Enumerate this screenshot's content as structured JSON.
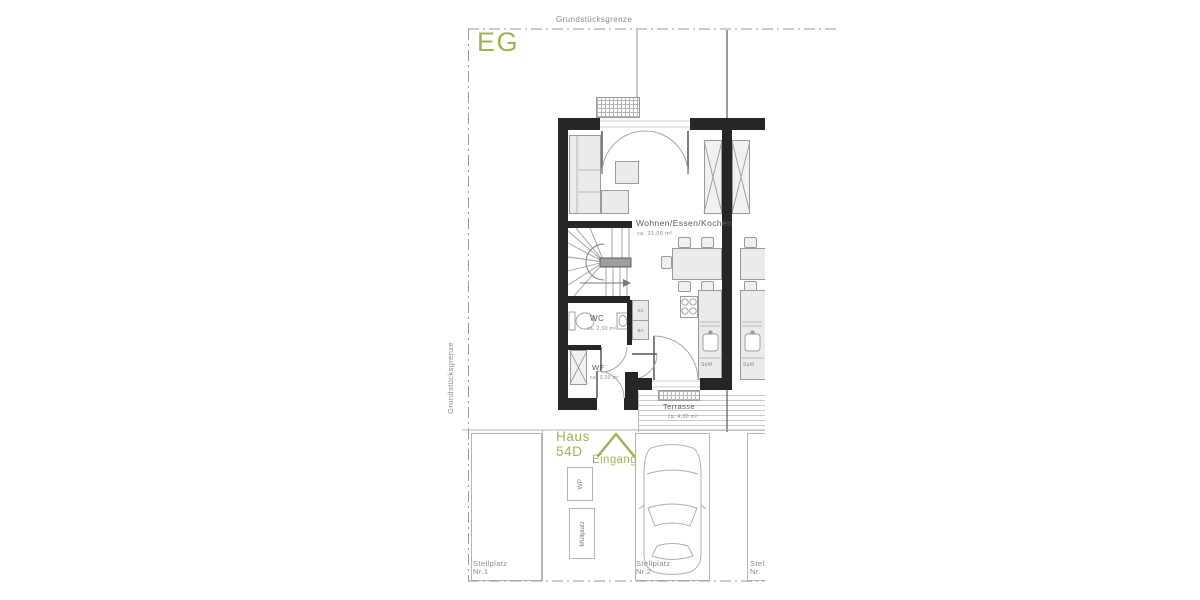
{
  "colors": {
    "accent_green": "#a3b155",
    "wall_black": "#262626",
    "line_gray": "#9a9a9a",
    "text_gray": "#8a8a8a"
  },
  "plan": {
    "floor_label": "EG",
    "boundary": {
      "top_label": "Grundstücksgrenze",
      "left_label": "Grundstücksgrenze"
    },
    "rooms": {
      "living": {
        "name": "Wohnen/Essen/Kochen",
        "area": "ca. 31,00 m²"
      },
      "wc": {
        "name": "WC",
        "area": "ca. 2,00 m²"
      },
      "wf": {
        "name": "WF",
        "area": "ca. 3,00 m²"
      },
      "terrace": {
        "name": "Terrasse",
        "area": "ca. 4,00 m²"
      }
    },
    "kitchen": {
      "ks": "KS",
      "ba": "BA",
      "spm": "SpM"
    },
    "house": {
      "line1": "Haus",
      "line2": "54D",
      "entrance": "Eingang"
    },
    "outdoor": {
      "wp": "WP",
      "muell": "Müllplatz"
    },
    "parking": {
      "stall1": {
        "line1": "Stellplatz",
        "line2": "Nr.1"
      },
      "stall2": {
        "line1": "Stellplatz",
        "line2": "Nr.2"
      },
      "stall3": {
        "line1": "Stellplatz",
        "line2": "Nr."
      }
    }
  }
}
